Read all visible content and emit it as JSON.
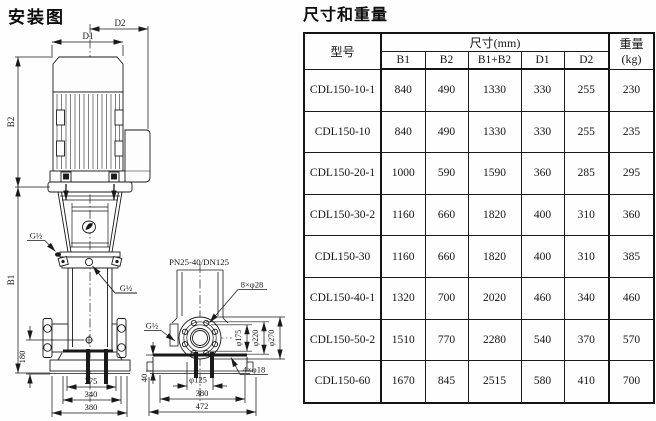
{
  "diagram": {
    "title": "安装图",
    "front": {
      "dim_d2": "D2",
      "dim_d1": "D1",
      "dim_b2": "B2",
      "dim_b1": "B1",
      "dim_180": "180",
      "dim_275": "275",
      "dim_340": "340",
      "dim_380": "380",
      "port_top": "G½",
      "port_mid": "G½"
    },
    "side": {
      "flange_spec": "PN25-40/DN125",
      "bolt_holes": "8×φ28",
      "port": "G½",
      "dia_175": "φ175",
      "dia_220": "φ220",
      "dia_270": "φ270",
      "dia_125": "φ125",
      "base_holes": "4×φ18",
      "dim_40": "40",
      "dim_380": "380",
      "dim_472": "472"
    }
  },
  "table": {
    "title": "尺寸和重量",
    "header": {
      "model": "型号",
      "dims_group": "尺寸(mm)",
      "cols": [
        "B1",
        "B2",
        "B1+B2",
        "D1",
        "D2"
      ],
      "weight": "重量(kg)"
    },
    "rows": [
      {
        "model": "CDL150-10-1",
        "b1": "840",
        "b2": "490",
        "b1b2": "1330",
        "d1": "330",
        "d2": "255",
        "weight": "230"
      },
      {
        "model": "CDL150-10",
        "b1": "840",
        "b2": "490",
        "b1b2": "1330",
        "d1": "330",
        "d2": "255",
        "weight": "235"
      },
      {
        "model": "CDL150-20-1",
        "b1": "1000",
        "b2": "590",
        "b1b2": "1590",
        "d1": "360",
        "d2": "285",
        "weight": "295"
      },
      {
        "model": "CDL150-30-2",
        "b1": "1160",
        "b2": "660",
        "b1b2": "1820",
        "d1": "400",
        "d2": "310",
        "weight": "360"
      },
      {
        "model": "CDL150-30",
        "b1": "1160",
        "b2": "660",
        "b1b2": "1820",
        "d1": "400",
        "d2": "310",
        "weight": "385"
      },
      {
        "model": "CDL150-40-1",
        "b1": "1320",
        "b2": "700",
        "b1b2": "2020",
        "d1": "460",
        "d2": "340",
        "weight": "460"
      },
      {
        "model": "CDL150-50-2",
        "b1": "1510",
        "b2": "770",
        "b1b2": "2280",
        "d1": "540",
        "d2": "370",
        "weight": "570"
      },
      {
        "model": "CDL150-60",
        "b1": "1670",
        "b2": "845",
        "b1b2": "2515",
        "d1": "580",
        "d2": "410",
        "weight": "700"
      }
    ]
  },
  "colors": {
    "ink": "#1a1a1a",
    "background": "#fefefe"
  }
}
